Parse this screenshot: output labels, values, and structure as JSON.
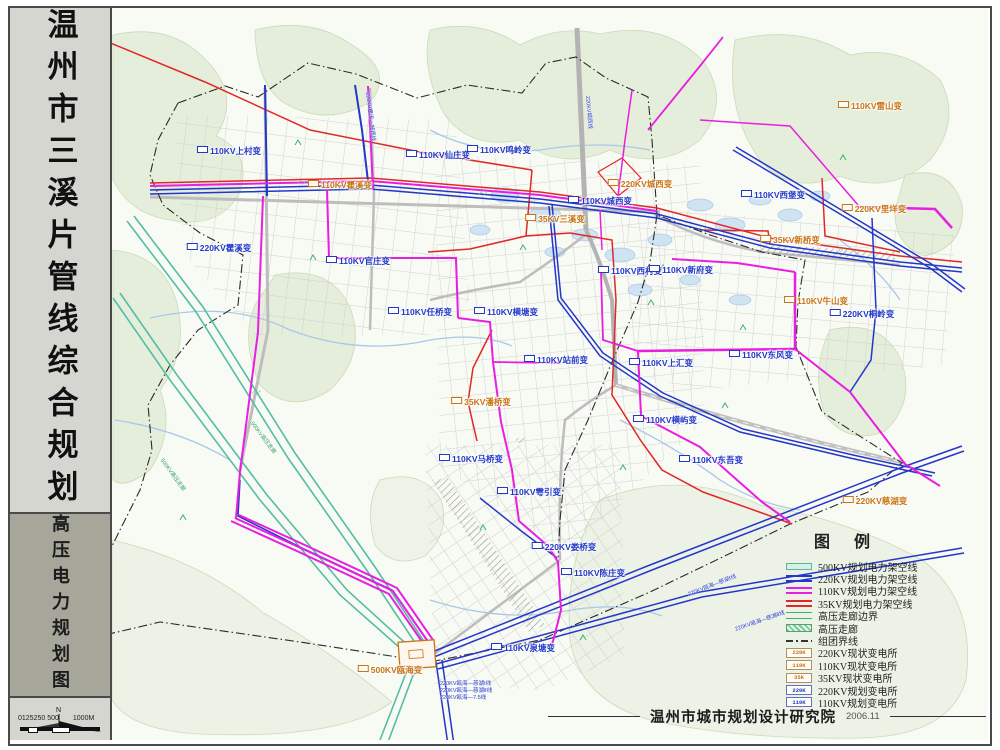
{
  "sidebar": {
    "title": "温州市三溪片管线综合规划",
    "subtitle": "高压电力规划图",
    "north_label": "N",
    "scale_text": "0125250 500",
    "scale_unit": "1000M"
  },
  "legend": {
    "title": "图  例",
    "items": [
      {
        "label": "500KV规划电力架空线"
      },
      {
        "label": "220KV规划电力架空线"
      },
      {
        "label": "110KV规划电力架空线"
      },
      {
        "label": "35KV规划电力架空线"
      },
      {
        "label": "高压走廊边界"
      },
      {
        "label": "高压走廊"
      },
      {
        "label": "组团界线"
      },
      {
        "label": "220KV现状变电所",
        "swatch_text": "220K"
      },
      {
        "label": "110KV现状变电所",
        "swatch_text": "110K"
      },
      {
        "label": "35KV现状变电所",
        "swatch_text": "35K"
      },
      {
        "label": "220KV规划变电所",
        "swatch_text": "220K"
      },
      {
        "label": "110KV规划变电所",
        "swatch_text": "110K"
      }
    ]
  },
  "credit": {
    "institute": "温州市城市规划设计研究院",
    "date": "2006.11"
  },
  "map": {
    "substations": [
      {
        "name": "110KV上村变",
        "x": 229,
        "y": 151,
        "t": "p"
      },
      {
        "name": "110KV瞿溪变",
        "x": 340,
        "y": 185,
        "t": "e"
      },
      {
        "name": "220KV瞿溪变",
        "x": 219,
        "y": 248,
        "t": "p"
      },
      {
        "name": "110KV官庄变",
        "x": 358,
        "y": 261,
        "t": "p"
      },
      {
        "name": "110KV仙庄变",
        "x": 438,
        "y": 155,
        "t": "p"
      },
      {
        "name": "110KV鸣岭变",
        "x": 499,
        "y": 150,
        "t": "p"
      },
      {
        "name": "220KV城西变",
        "x": 640,
        "y": 184,
        "t": "e"
      },
      {
        "name": "110KV城西变",
        "x": 600,
        "y": 201,
        "t": "p"
      },
      {
        "name": "35KV三溪变",
        "x": 555,
        "y": 219,
        "t": "e"
      },
      {
        "name": "110KV西村变",
        "x": 630,
        "y": 271,
        "t": "p"
      },
      {
        "name": "110KV雷山变",
        "x": 870,
        "y": 106,
        "t": "e"
      },
      {
        "name": "110KV西堡变",
        "x": 773,
        "y": 195,
        "t": "p"
      },
      {
        "name": "220KV里垟变",
        "x": 874,
        "y": 209,
        "t": "e"
      },
      {
        "name": "35KV新桥变",
        "x": 790,
        "y": 240,
        "t": "e"
      },
      {
        "name": "110KV新府变",
        "x": 681,
        "y": 270,
        "t": "p"
      },
      {
        "name": "110KV牛山变",
        "x": 816,
        "y": 301,
        "t": "e"
      },
      {
        "name": "220KV桐岭变",
        "x": 862,
        "y": 314,
        "t": "p"
      },
      {
        "name": "110KV任桥变",
        "x": 420,
        "y": 312,
        "t": "p"
      },
      {
        "name": "110KV横塘变",
        "x": 506,
        "y": 312,
        "t": "p"
      },
      {
        "name": "110KV站前变",
        "x": 556,
        "y": 360,
        "t": "p"
      },
      {
        "name": "110KV上汇变",
        "x": 661,
        "y": 363,
        "t": "p"
      },
      {
        "name": "110KV东风变",
        "x": 761,
        "y": 355,
        "t": "p"
      },
      {
        "name": "110KV横屿变",
        "x": 665,
        "y": 420,
        "t": "p"
      },
      {
        "name": "35KV潘桥变",
        "x": 481,
        "y": 402,
        "t": "e"
      },
      {
        "name": "110KV马桥变",
        "x": 471,
        "y": 459,
        "t": "p"
      },
      {
        "name": "110KV雩引变",
        "x": 529,
        "y": 492,
        "t": "p"
      },
      {
        "name": "110KV东吾变",
        "x": 711,
        "y": 460,
        "t": "p"
      },
      {
        "name": "220KV娄桥变",
        "x": 564,
        "y": 547,
        "t": "p"
      },
      {
        "name": "110KV陈庄变",
        "x": 593,
        "y": 573,
        "t": "p"
      },
      {
        "name": "500KV瓯海变",
        "x": 390,
        "y": 670,
        "t": "e"
      },
      {
        "name": "110KV泉塘变",
        "x": 523,
        "y": 648,
        "t": "p"
      },
      {
        "name": "220KV慈湖变",
        "x": 875,
        "y": 501,
        "t": "e"
      }
    ],
    "annotations": [
      {
        "text": "220KV瓯海—慈湖Ⅰ线",
        "x": 440,
        "y": 679,
        "rot": 0,
        "c": "blue"
      },
      {
        "text": "220KV瓯海—慈湖Ⅱ线",
        "x": 440,
        "y": 686,
        "rot": 0,
        "c": "blue"
      },
      {
        "text": "220KV瓯海—7.5线",
        "x": 440,
        "y": 693,
        "rot": 0,
        "c": "blue"
      },
      {
        "text": "220KV瓯海—慈湖Ⅰ线",
        "x": 688,
        "y": 590,
        "rot": -21,
        "c": "blue"
      },
      {
        "text": "220KV瓯海—慈湖Ⅱ线",
        "x": 735,
        "y": 625,
        "rot": -19,
        "c": "blue"
      },
      {
        "text": "220KV瞿溪—城西线",
        "x": 368,
        "y": 88,
        "rot": 83,
        "c": "blue"
      },
      {
        "text": "220KV城西线",
        "x": 588,
        "y": 92,
        "rot": 85,
        "c": "blue"
      },
      {
        "text": "500KV高压走廊",
        "x": 162,
        "y": 455,
        "rot": 54,
        "c": "green"
      },
      {
        "text": "500KV高压走廊",
        "x": 252,
        "y": 418,
        "rot": 53,
        "c": "green"
      }
    ]
  },
  "colors": {
    "kv500": "#56b99a",
    "kv220": "#2437c8",
    "kv110": "#e81ee0",
    "kv35": "#e02828",
    "existing_text": "#c87414",
    "planned_text": "#2238c8",
    "boundary": "#2a2a2a"
  }
}
